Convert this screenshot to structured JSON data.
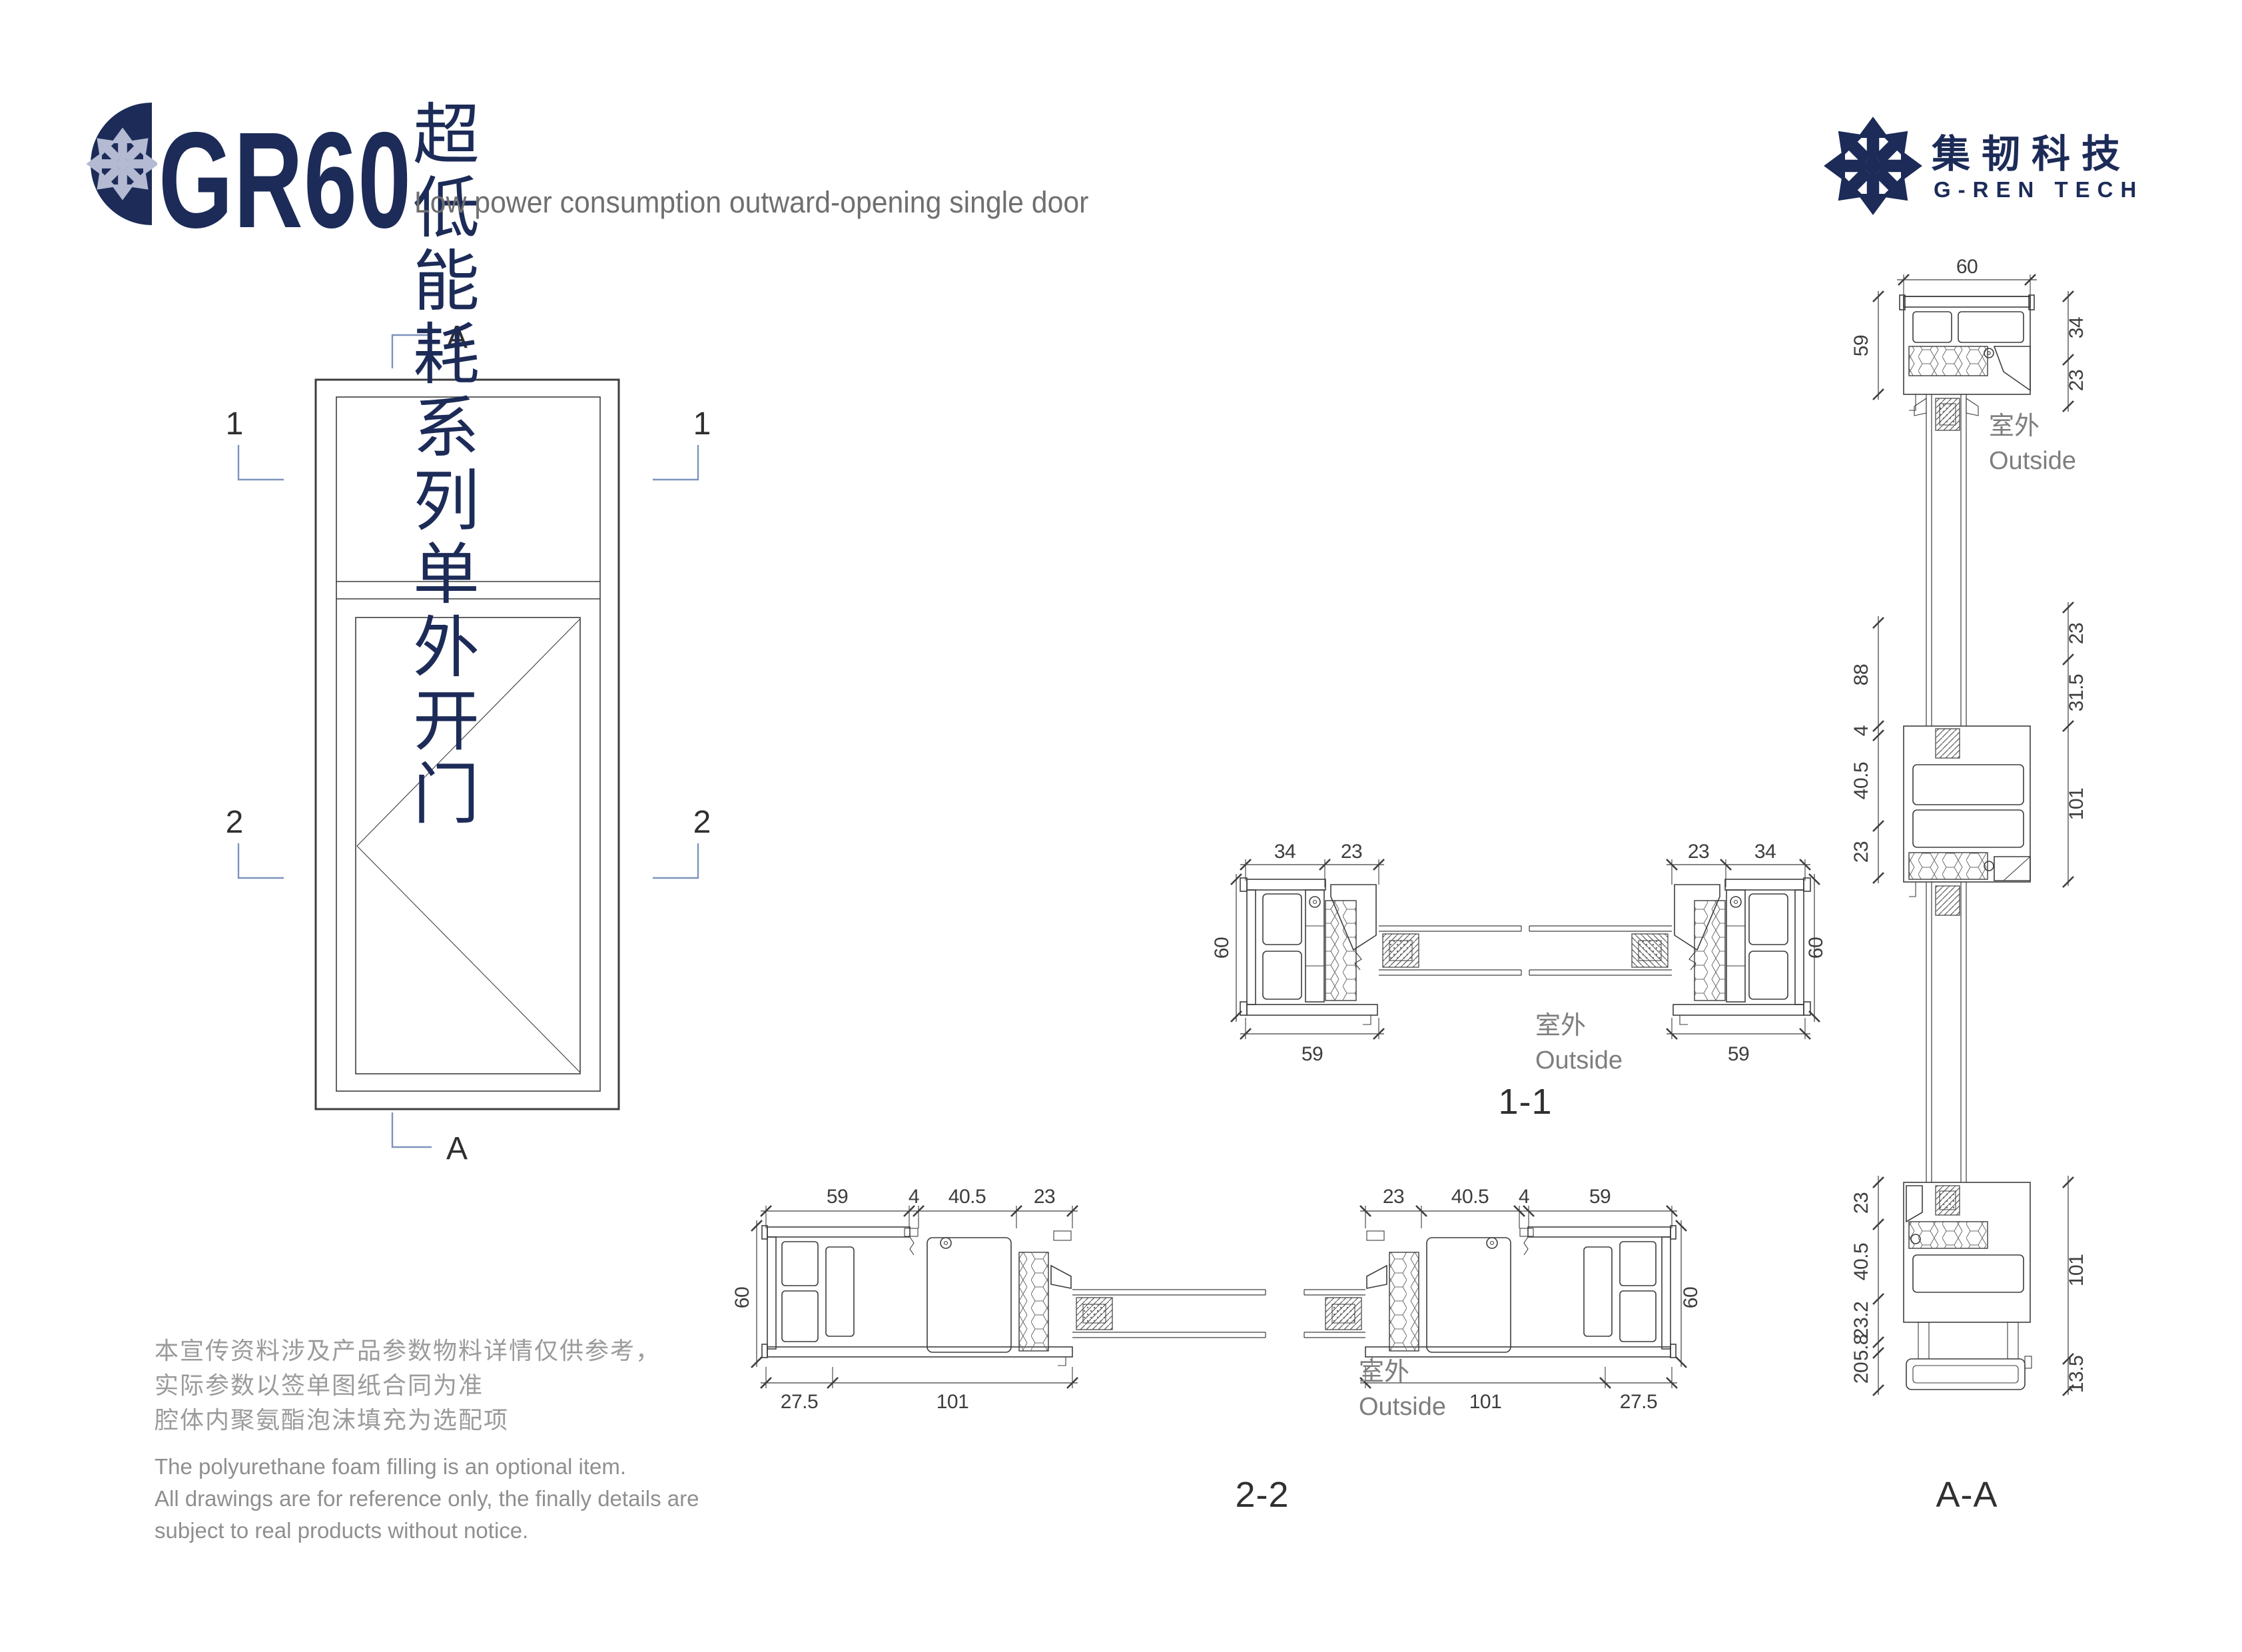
{
  "header": {
    "product_code": "GR60",
    "title_zh": "超低能耗系列单外开门",
    "title_en": "Low power consumption outward-opening single door",
    "brand_zh": "集韧科技",
    "brand_en": "G-REN TECH"
  },
  "colors": {
    "navy": "#1c2b57",
    "marker_blue": "#7e93bc",
    "line": "#3d3d3d",
    "muted_gray": "#8f8f8f"
  },
  "elevation": {
    "marker_a": "A",
    "marker_1": "1",
    "marker_2": "2"
  },
  "labels": {
    "outside_zh": "室外",
    "outside_en": "Outside"
  },
  "sections": {
    "s11": {
      "label": "1-1",
      "d34": "34",
      "d23": "23",
      "d60": "60",
      "d59": "59"
    },
    "s22": {
      "label": "2-2",
      "d59": "59",
      "d4": "4",
      "d405": "40.5",
      "d23": "23",
      "d60": "60",
      "d275": "27.5",
      "d101": "101"
    },
    "saa": {
      "label": "A-A",
      "d60": "60",
      "d59": "59",
      "d34": "34",
      "d23": "23",
      "d88": "88",
      "d4": "4",
      "d405": "40.5",
      "d315": "31.5",
      "d101": "101",
      "d232": "23.2",
      "d58": "5.8",
      "d20": "20",
      "d135": "13.5"
    }
  },
  "notes": {
    "zh1": "本宣传资料涉及产品参数物料详情仅供参考，",
    "zh2": "实际参数以签单图纸合同为准",
    "zh3": "腔体内聚氨酯泡沫填充为选配项",
    "en1": "The polyurethane foam filling is an optional item.",
    "en2": "All drawings are for reference only, the finally details are",
    "en3": "subject to real products without notice."
  }
}
